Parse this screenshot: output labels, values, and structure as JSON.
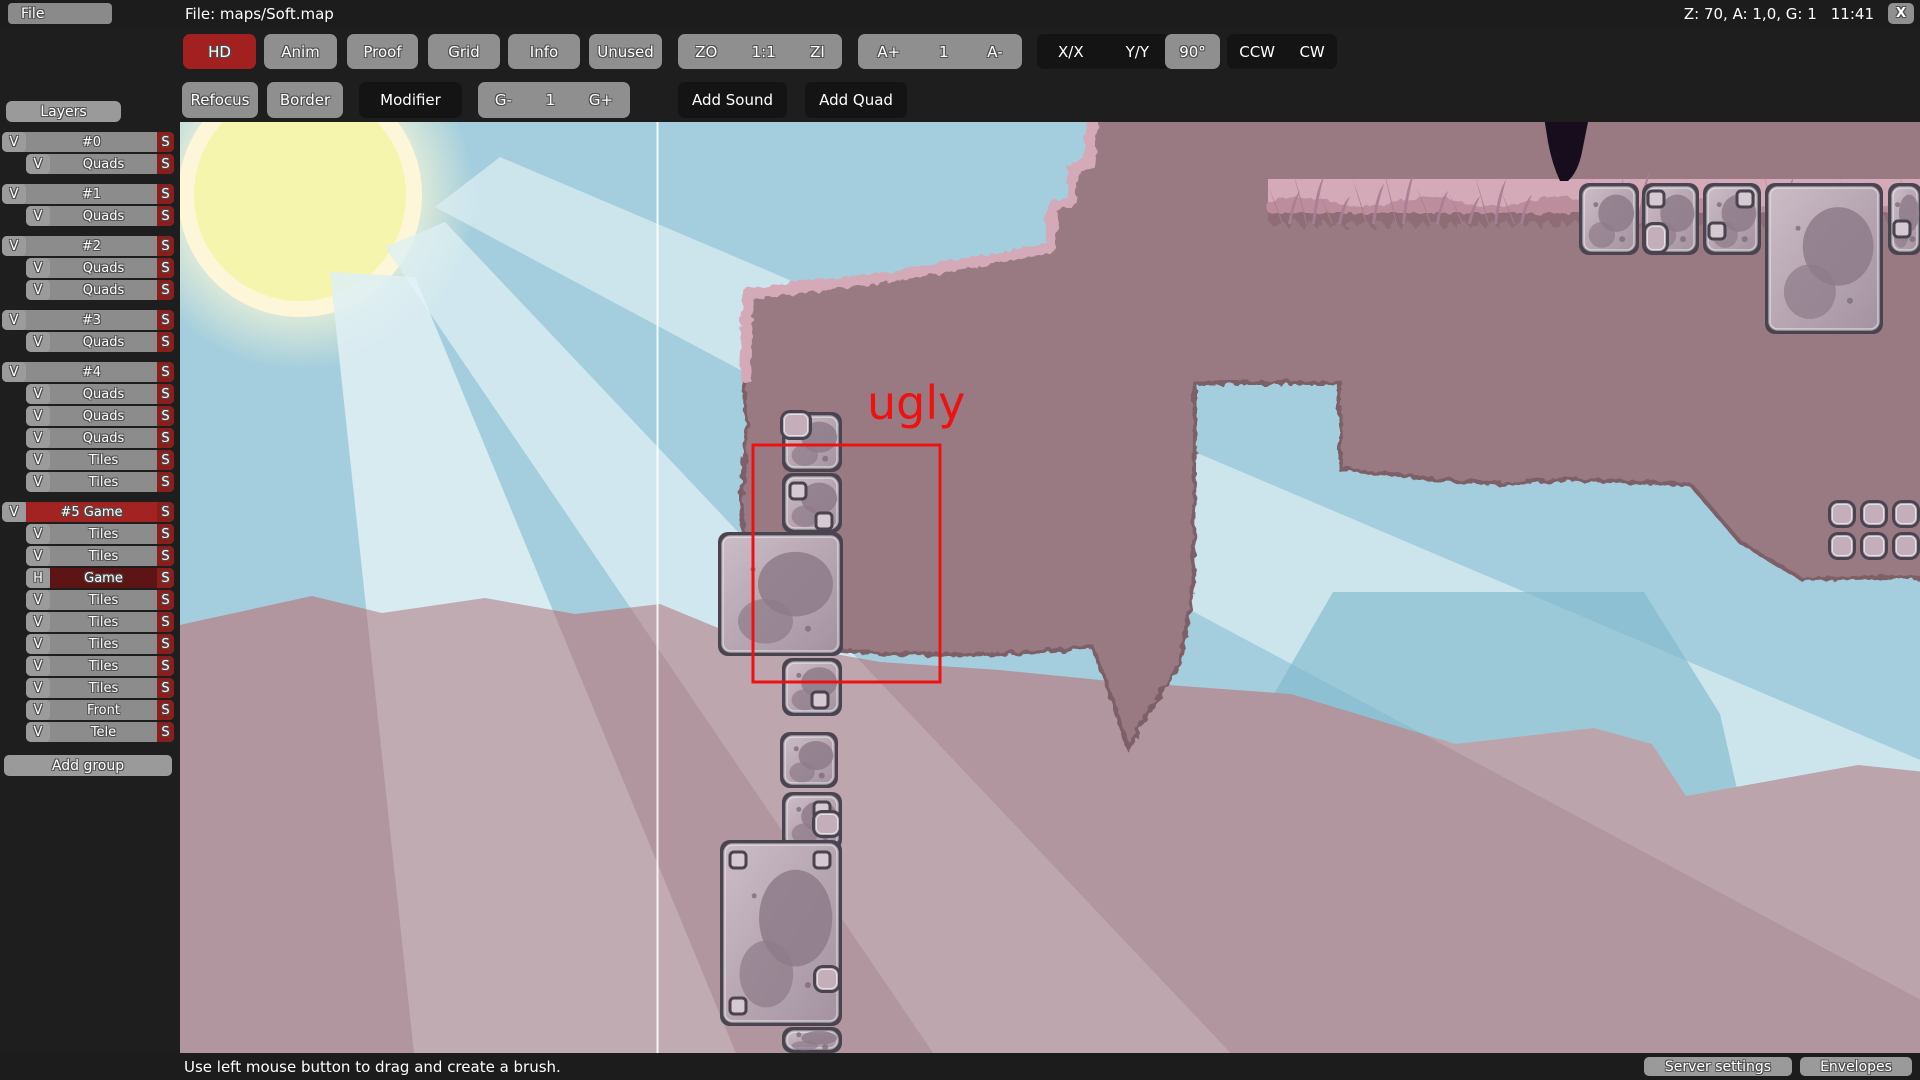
{
  "window": {
    "file_menu": "File",
    "title": "File: maps/Soft.map",
    "status_right": "Z: 70, A: 1,0, G: 1",
    "clock": "11:41",
    "close": "X"
  },
  "toolbar_row1": [
    {
      "label": "HD",
      "style": "red"
    },
    {
      "label": "Anim",
      "style": "gray"
    },
    {
      "label": "Proof",
      "style": "gray"
    },
    {
      "label": "Grid",
      "style": "gray"
    },
    {
      "label": "Info",
      "style": "gray"
    },
    {
      "label": "Unused",
      "style": "gray"
    },
    {
      "group": [
        "ZO",
        "1:1",
        "ZI"
      ],
      "style": "gray"
    },
    {
      "group": [
        "A+",
        "1",
        "A-"
      ],
      "style": "gray"
    },
    {
      "group": [
        "X/X",
        "Y/Y"
      ],
      "style": "dark"
    },
    {
      "label": "90°",
      "style": "gray"
    },
    {
      "group": [
        "CCW",
        "CW"
      ],
      "style": "dark"
    }
  ],
  "toolbar_row2": [
    {
      "label": "Refocus",
      "style": "gray"
    },
    {
      "label": "Border",
      "style": "gray"
    },
    {
      "label": "Modifier",
      "style": "dark"
    },
    {
      "group": [
        "G-",
        "1",
        "G+"
      ],
      "style": "gray"
    },
    {
      "label": "Add Sound",
      "style": "dark"
    },
    {
      "label": "Add Quad",
      "style": "dark"
    }
  ],
  "layers_panel": {
    "header": "Layers",
    "add_group": "Add group",
    "select_label": "S",
    "groups": [
      {
        "label": "#0",
        "v": "V",
        "selected": false,
        "items": [
          {
            "label": "Quads",
            "v": "V"
          }
        ]
      },
      {
        "label": "#1",
        "v": "V",
        "selected": false,
        "items": [
          {
            "label": "Quads",
            "v": "V"
          }
        ]
      },
      {
        "label": "#2",
        "v": "V",
        "selected": false,
        "items": [
          {
            "label": "Quads",
            "v": "V"
          },
          {
            "label": "Quads",
            "v": "V"
          }
        ]
      },
      {
        "label": "#3",
        "v": "V",
        "selected": false,
        "items": [
          {
            "label": "Quads",
            "v": "V"
          }
        ]
      },
      {
        "label": "#4",
        "v": "V",
        "selected": false,
        "items": [
          {
            "label": "Quads",
            "v": "V"
          },
          {
            "label": "Quads",
            "v": "V"
          },
          {
            "label": "Quads",
            "v": "V"
          },
          {
            "label": "Tiles",
            "v": "V"
          },
          {
            "label": "Tiles",
            "v": "V"
          }
        ]
      },
      {
        "label": "#5 Game",
        "v": "V",
        "selected": true,
        "items": [
          {
            "label": "Tiles",
            "v": "V"
          },
          {
            "label": "Tiles",
            "v": "V"
          },
          {
            "label": "Game",
            "v": "H",
            "hidden": true
          },
          {
            "label": "Tiles",
            "v": "V"
          },
          {
            "label": "Tiles",
            "v": "V"
          },
          {
            "label": "Tiles",
            "v": "V"
          },
          {
            "label": "Tiles",
            "v": "V"
          },
          {
            "label": "Tiles",
            "v": "V"
          },
          {
            "label": "Front",
            "v": "V"
          },
          {
            "label": "Tele",
            "v": "V"
          }
        ]
      }
    ]
  },
  "status_bar": {
    "hint": "Use left mouse button to drag and create a brush.",
    "server_settings": "Server settings",
    "envelopes": "Envelopes"
  },
  "map": {
    "annotation": {
      "text": "ugly",
      "color": "#ee1111"
    },
    "colors": {
      "sky": "#a4cedd",
      "beam": "#d6ebf1",
      "sun_core": "#f6f5ae",
      "sun_ring": "#fdf6d8",
      "sun_glow": "#fdf9d7",
      "hill": "#8cc0d2",
      "mountain": "#b1969f",
      "terrain": "#997a82",
      "terrain_edge": "#7d5e67",
      "band": "#d4a9b8",
      "band_wave": "#bb8d9d",
      "teeth": "#8f6c76",
      "grass": "#a87f92",
      "trunk": "#180d1c",
      "tile_border": "#4b4450",
      "tile_light": "#cbbcc6",
      "tile_dark": "#a492a0",
      "tile_blob": "#8e7b89",
      "tile_small": "#d6c9d1",
      "plain_fill": "#c3aeb9"
    },
    "tiles": [
      {
        "x": 602,
        "y": 290,
        "w": 60,
        "h": 60,
        "kind": "stone",
        "sq": []
      },
      {
        "x": 600,
        "y": 288,
        "w": 32,
        "h": 30,
        "kind": "plain"
      },
      {
        "x": 602,
        "y": 351,
        "w": 60,
        "h": 60,
        "kind": "stone",
        "sq": [
          [
            8,
            10
          ],
          [
            34,
            40
          ]
        ]
      },
      {
        "x": 538,
        "y": 410,
        "w": 125,
        "h": 124,
        "kind": "stone",
        "sq": []
      },
      {
        "x": 602,
        "y": 536,
        "w": 60,
        "h": 58,
        "kind": "stone",
        "sq": [
          [
            30,
            34
          ]
        ]
      },
      {
        "x": 600,
        "y": 610,
        "w": 58,
        "h": 56,
        "kind": "stone",
        "sq": []
      },
      {
        "x": 602,
        "y": 670,
        "w": 60,
        "h": 58,
        "kind": "stone",
        "sq": [
          [
            32,
            10
          ]
        ]
      },
      {
        "x": 540,
        "y": 718,
        "w": 122,
        "h": 186,
        "kind": "stone",
        "sq": [
          [
            10,
            12
          ],
          [
            94,
            12
          ],
          [
            10,
            158
          ]
        ]
      },
      {
        "x": 632,
        "y": 688,
        "w": 30,
        "h": 28,
        "kind": "plain"
      },
      {
        "x": 633,
        "y": 843,
        "w": 28,
        "h": 28,
        "kind": "plain"
      },
      {
        "x": 602,
        "y": 905,
        "w": 60,
        "h": 26,
        "kind": "stone",
        "sq": []
      },
      {
        "x": 1399,
        "y": 61,
        "w": 60,
        "h": 72,
        "kind": "stone",
        "sq": []
      },
      {
        "x": 1462,
        "y": 61,
        "w": 57,
        "h": 72,
        "kind": "stone",
        "sq": [
          [
            6,
            8
          ]
        ]
      },
      {
        "x": 1463,
        "y": 100,
        "w": 26,
        "h": 32,
        "kind": "plain"
      },
      {
        "x": 1523,
        "y": 61,
        "w": 58,
        "h": 72,
        "kind": "stone",
        "sq": [
          [
            34,
            8
          ],
          [
            6,
            40
          ]
        ]
      },
      {
        "x": 1585,
        "y": 61,
        "w": 118,
        "h": 151,
        "kind": "stone",
        "sq": []
      },
      {
        "x": 1708,
        "y": 61,
        "w": 34,
        "h": 72,
        "kind": "stone",
        "sq": [
          [
            6,
            38
          ]
        ]
      },
      {
        "x": 1648,
        "y": 378,
        "w": 28,
        "h": 28,
        "kind": "plain"
      },
      {
        "x": 1680,
        "y": 378,
        "w": 28,
        "h": 28,
        "kind": "plain"
      },
      {
        "x": 1712,
        "y": 378,
        "w": 28,
        "h": 28,
        "kind": "plain"
      },
      {
        "x": 1648,
        "y": 410,
        "w": 28,
        "h": 28,
        "kind": "plain"
      },
      {
        "x": 1680,
        "y": 410,
        "w": 28,
        "h": 28,
        "kind": "plain"
      },
      {
        "x": 1712,
        "y": 410,
        "w": 28,
        "h": 28,
        "kind": "plain"
      }
    ],
    "grass": [
      [
        1102,
        36
      ],
      [
        1126,
        52
      ],
      [
        1152,
        30
      ],
      [
        1186,
        44
      ],
      [
        1216,
        56
      ],
      [
        1250,
        36
      ],
      [
        1282,
        30
      ],
      [
        1308,
        48
      ],
      [
        1334,
        32
      ],
      [
        1424,
        46
      ],
      [
        1452,
        58
      ],
      [
        1488,
        34
      ],
      [
        1518,
        46
      ],
      [
        1556,
        30
      ],
      [
        1596,
        52
      ],
      [
        1636,
        36
      ],
      [
        1672,
        46
      ],
      [
        1706,
        32
      ],
      [
        1732,
        50
      ]
    ]
  }
}
